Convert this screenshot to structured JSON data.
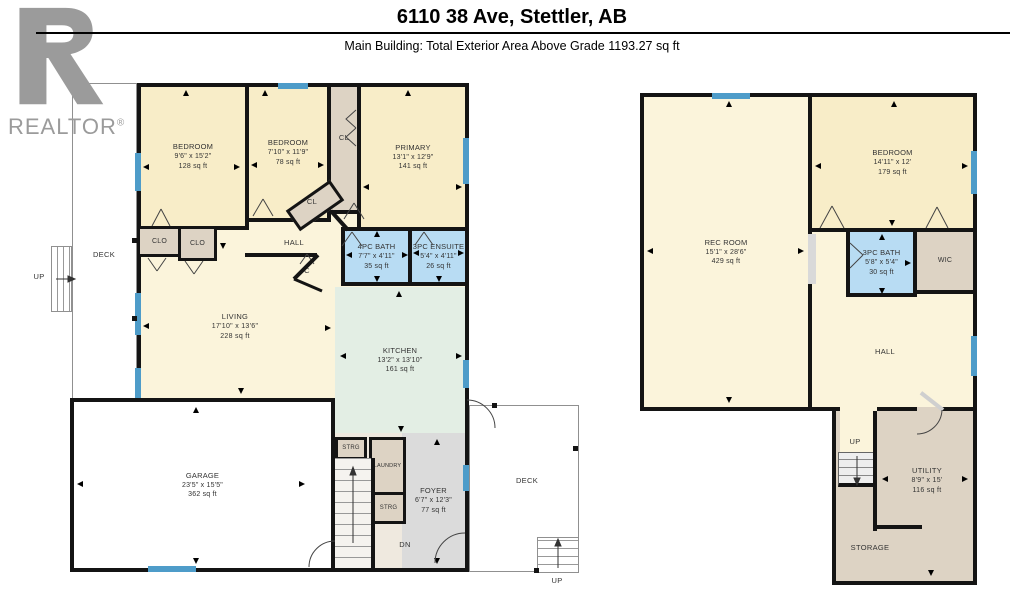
{
  "header": {
    "title": "6110 38 Ave, Stettler, AB",
    "subtitle": "Main Building: Total Exterior Area Above Grade 1193.27 sq ft"
  },
  "logo": {
    "text": "REALTOR",
    "reg": "®"
  },
  "floors": {
    "main": {
      "bedroom1": {
        "name": "BEDROOM",
        "dims": "9'6\" x 15'2\"",
        "area": "128 sq ft"
      },
      "bedroom2": {
        "name": "BEDROOM",
        "dims": "7'10\" x 11'9\"",
        "area": "78 sq ft"
      },
      "primary": {
        "name": "PRIMARY",
        "dims": "13'1\" x 12'9\"",
        "area": "141 sq ft"
      },
      "bath": {
        "name": "4PC BATH",
        "dims": "7'7\" x 4'11\"",
        "area": "35 sq ft"
      },
      "ensuite": {
        "name": "3PC ENSUITE",
        "dims": "5'4\" x 4'11\"",
        "area": "26 sq ft"
      },
      "living": {
        "name": "LIVING",
        "dims": "17'10\" x 13'6\"",
        "area": "228 sq ft"
      },
      "kitchen": {
        "name": "KITCHEN",
        "dims": "13'2\" x 13'10\"",
        "area": "161 sq ft"
      },
      "garage": {
        "name": "GARAGE",
        "dims": "23'5\" x 15'5\"",
        "area": "362 sq ft"
      },
      "foyer": {
        "name": "FOYER",
        "dims": "6'7\" x 12'3\"",
        "area": "77 sq ft"
      },
      "hall": "HALL",
      "cl": "CL",
      "clo": "CLO",
      "c": "C",
      "strg": "STRG",
      "laundry": "LAUNDRY",
      "deck": "DECK",
      "up": "UP",
      "dn": "DN"
    },
    "basement": {
      "recroom": {
        "name": "REC ROOM",
        "dims": "15'1\" x 28'6\"",
        "area": "429 sq ft"
      },
      "bedroom": {
        "name": "BEDROOM",
        "dims": "14'11\" x 12'",
        "area": "179 sq ft"
      },
      "bath": {
        "name": "3PC BATH",
        "dims": "5'8\" x 5'4\"",
        "area": "30 sq ft"
      },
      "utility": {
        "name": "UTILITY",
        "dims": "8'9\" x 15'",
        "area": "116 sq ft"
      },
      "wic": "WIC",
      "hall": "HALL",
      "storage": "STORAGE",
      "up": "UP"
    }
  },
  "colors": {
    "room_cream": "#F8EDC8",
    "hall_cream": "#FBF4DB",
    "bath_blue": "#B8DCF3",
    "kitchen_mint": "#E3EEE4",
    "closet_tan": "#DDD3C4",
    "stair_tan": "#EFE9DF",
    "foyer_gray": "#DBDBDB",
    "window_blue": "#4E9CC9",
    "wall": "#141414"
  }
}
